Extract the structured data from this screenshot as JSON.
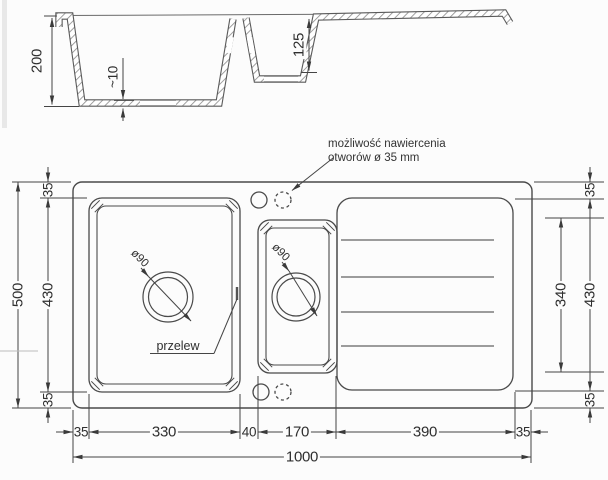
{
  "drawing_title": "sink technical drawing",
  "section_view": {
    "main_bowl_depth": "200",
    "bottom_thickness": "~10",
    "small_bowl_depth": "125"
  },
  "plan_view": {
    "note": {
      "line1": "możliwość nawiercenia",
      "line2": "otworów ø 35 mm"
    },
    "overflow_label": "przelew",
    "main_drain_diameter": "ø90",
    "small_drain_diameter": "ø90",
    "dims": {
      "total_height": "500",
      "total_width": "1000",
      "left_column": [
        "35",
        "430",
        "35"
      ],
      "right_column": [
        "35",
        "430",
        "35"
      ],
      "drainer_inner_height": "340",
      "bottom_row": [
        "35",
        "330",
        "40",
        "170",
        "390",
        "35"
      ]
    }
  },
  "colors": {
    "line": "#4a4a4a",
    "dim_line": "#454545",
    "arrow": "#3a3a3a",
    "hatch": "#8f8f8f",
    "text": "#2f2f2f",
    "background": "#fcfcfc"
  }
}
